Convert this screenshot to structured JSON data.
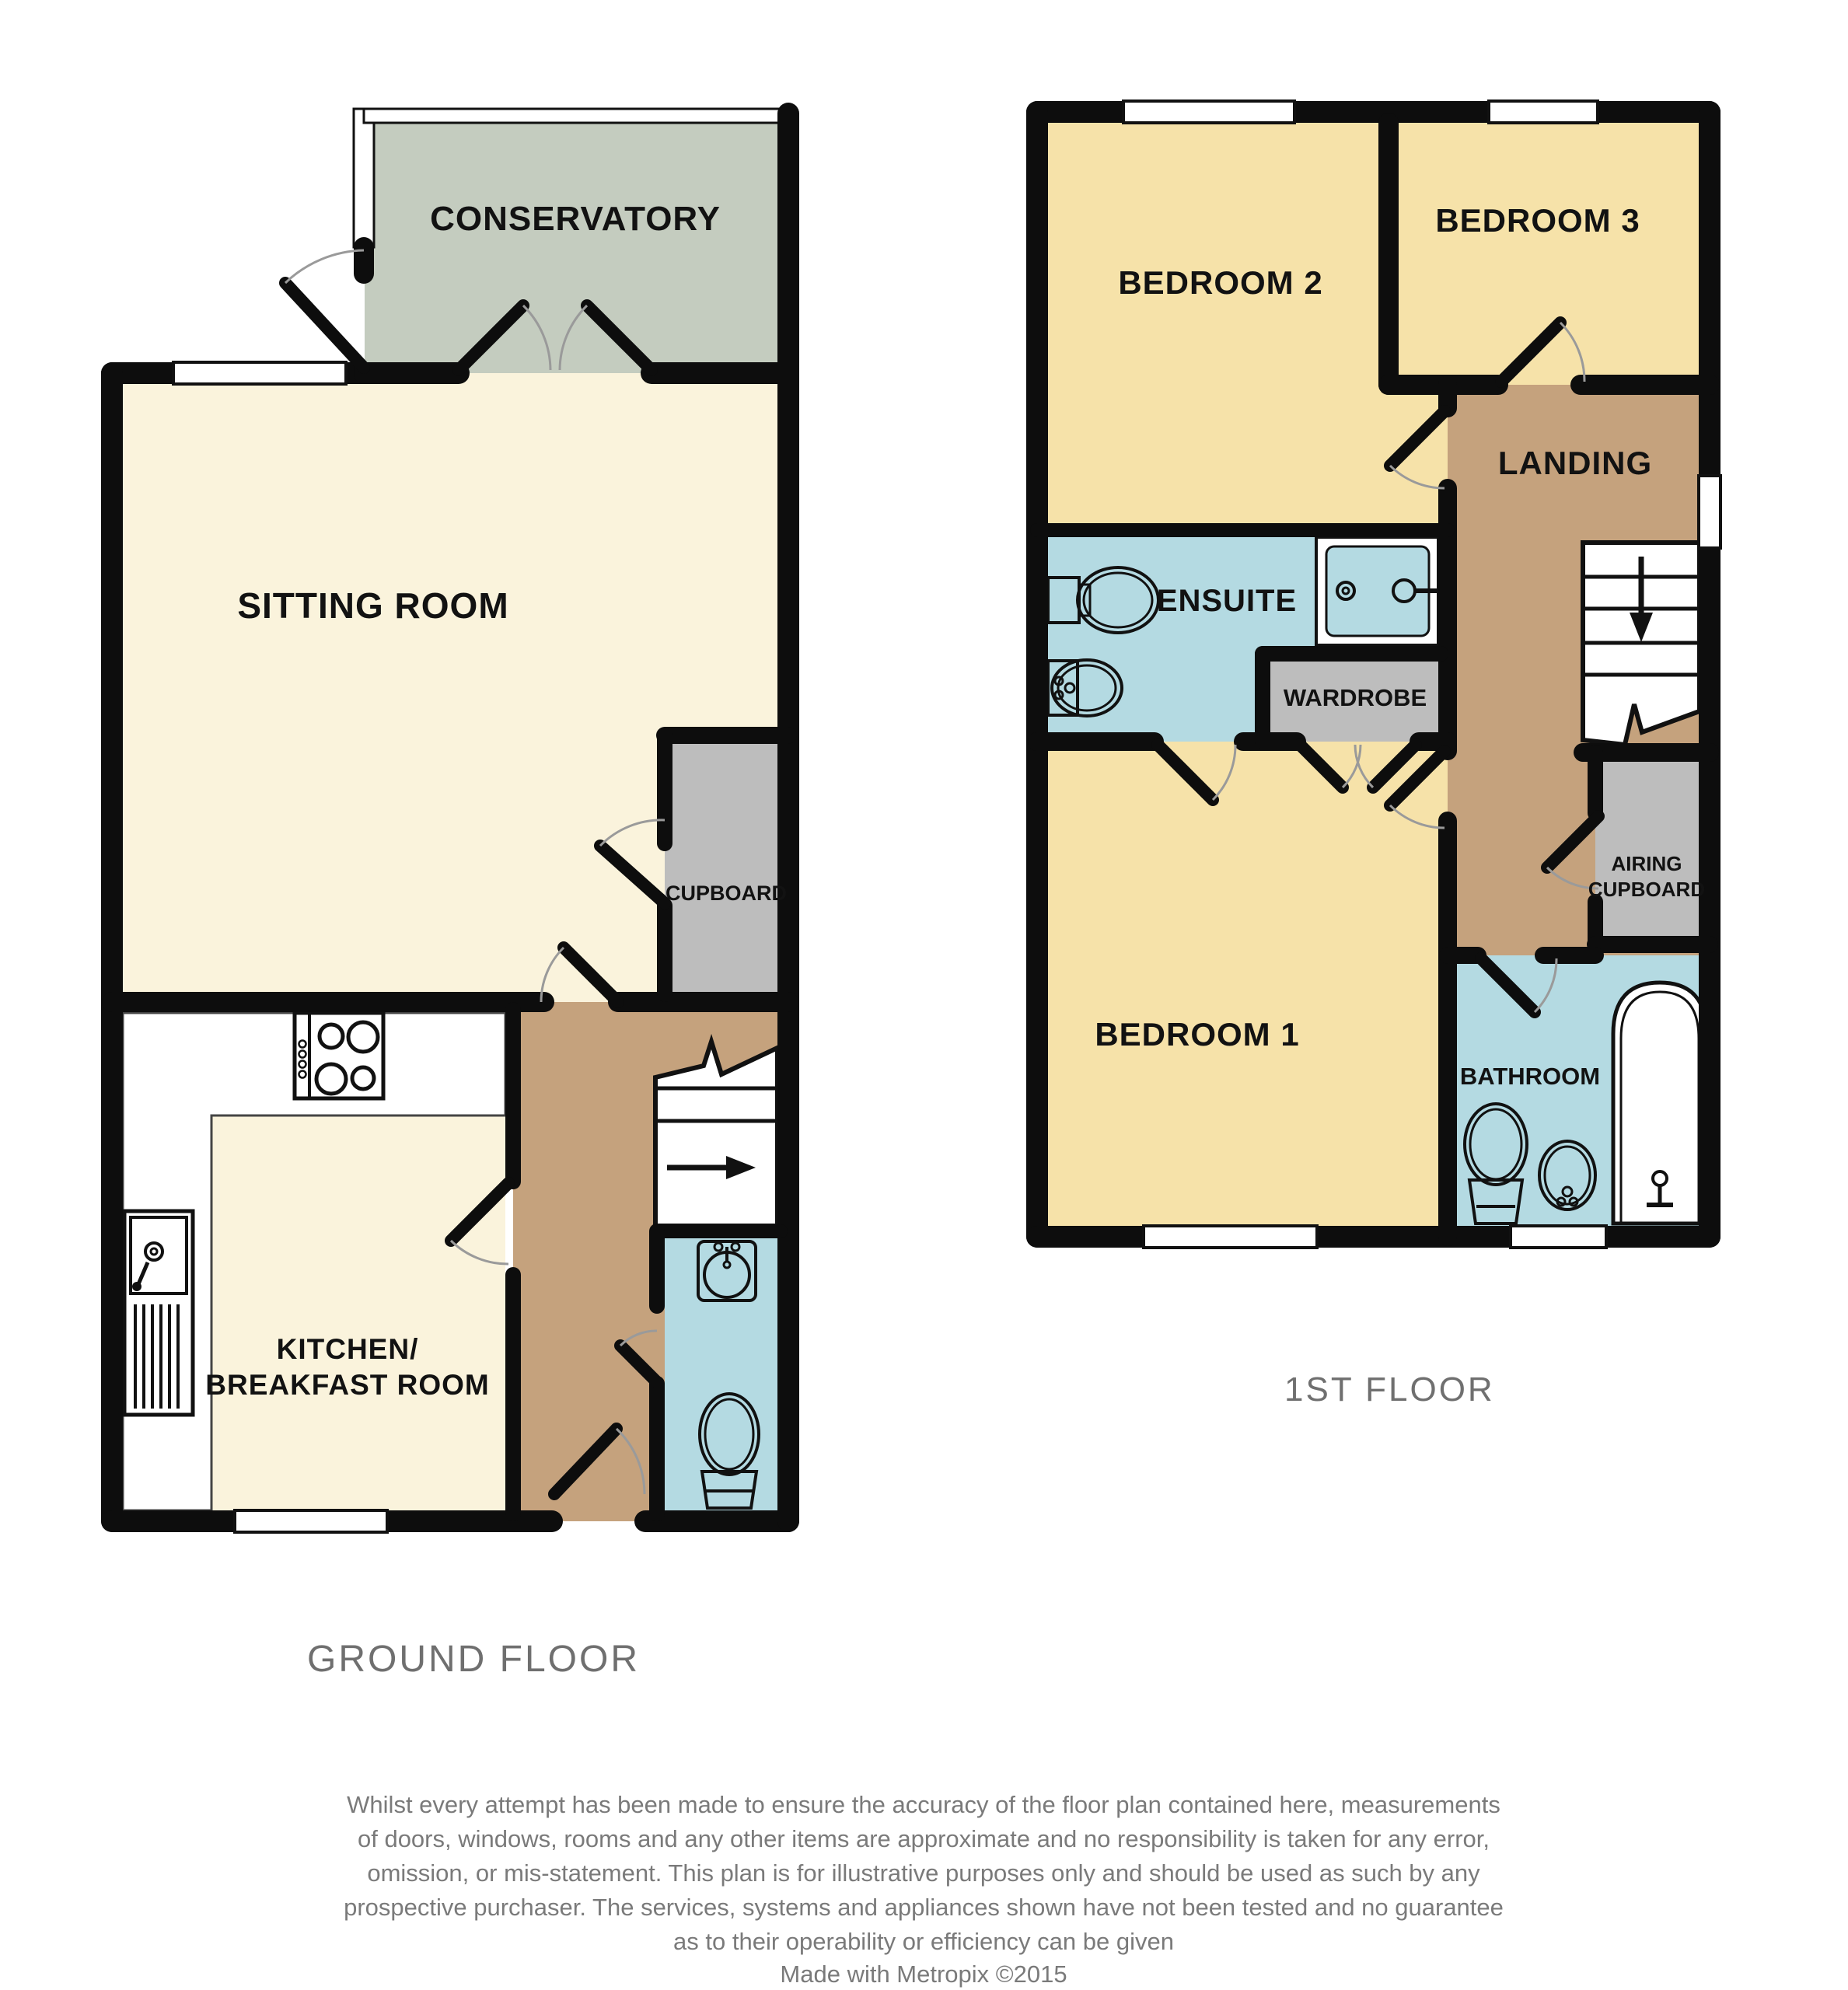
{
  "colors": {
    "room_cream": "#faf3dc",
    "room_gold": "#f6e2a9",
    "room_tan": "#c5a27d",
    "room_blue": "#b4dae2",
    "room_gray": "#bdbdbd",
    "conservatory_green": "#c4ccbf",
    "wall_black": "#0d0d0d",
    "caption_gray": "#6f6f6f"
  },
  "ground_floor": {
    "caption": "GROUND FLOOR",
    "rooms": {
      "conservatory": "CONSERVATORY",
      "sitting_room": "SITTING ROOM",
      "cupboard": "CUPBOARD",
      "kitchen_line1": "KITCHEN/",
      "kitchen_line2": "BREAKFAST ROOM"
    }
  },
  "first_floor": {
    "caption": "1ST FLOOR",
    "rooms": {
      "bedroom2": "BEDROOM 2",
      "bedroom3": "BEDROOM 3",
      "landing": "LANDING",
      "ensuite": "ENSUITE",
      "wardrobe": "WARDROBE",
      "bedroom1": "BEDROOM 1",
      "airing_line1": "AIRING",
      "airing_line2": "CUPBOARD",
      "bathroom": "BATHROOM"
    }
  },
  "footer": {
    "disclaimer_lines": [
      "Whilst every attempt has been made to ensure the accuracy of the floor plan contained here, measurements",
      "of doors, windows, rooms and any other items are approximate and no responsibility is taken for any error,",
      "omission, or mis-statement. This plan is for illustrative purposes only and should be used as such by any",
      "prospective purchaser. The services, systems and appliances shown have not been tested and no guarantee",
      "as to their operability or efficiency can be given"
    ],
    "credit": "Made with Metropix ©2015"
  }
}
